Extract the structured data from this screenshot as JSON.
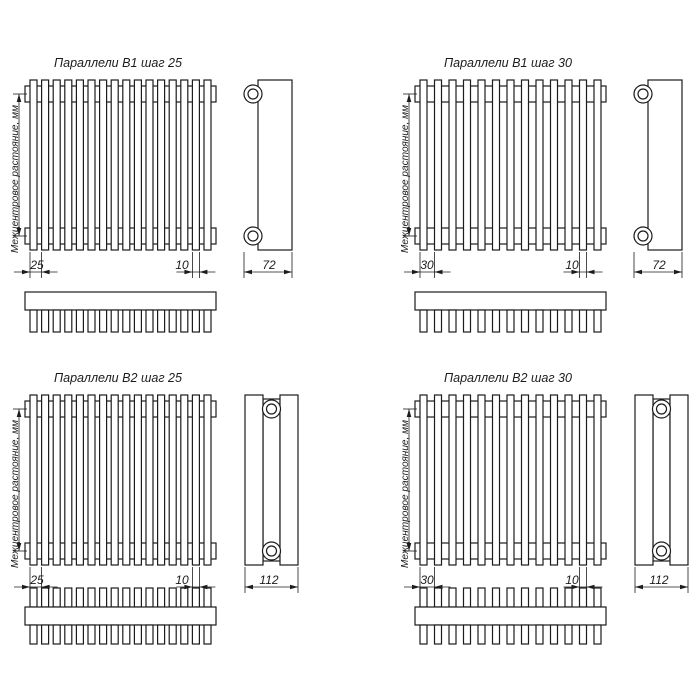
{
  "drawing": {
    "background_color": "#ffffff",
    "line_color": "#1c1c1c",
    "axis_label": "Межцентровое растояние, мм"
  },
  "panels": [
    {
      "id": "b1-step-25",
      "title": "Параллели В1 шаг 25",
      "variant": "B1",
      "tube_count": 16,
      "pitch_label": "25",
      "tube_width_label": "10",
      "depth_label": "72"
    },
    {
      "id": "b1-step-30",
      "title": "Параллели В1 шаг 30",
      "variant": "B1",
      "tube_count": 13,
      "pitch_label": "30",
      "tube_width_label": "10",
      "depth_label": "72"
    },
    {
      "id": "b2-step-25",
      "title": "Параллели В2 шаг 25",
      "variant": "B2",
      "tube_count": 16,
      "pitch_label": "25",
      "tube_width_label": "10",
      "depth_label": "112"
    },
    {
      "id": "b2-step-30",
      "title": "Параллели В2 шаг 30",
      "variant": "B2",
      "tube_count": 13,
      "pitch_label": "30",
      "tube_width_label": "10",
      "depth_label": "112"
    }
  ]
}
